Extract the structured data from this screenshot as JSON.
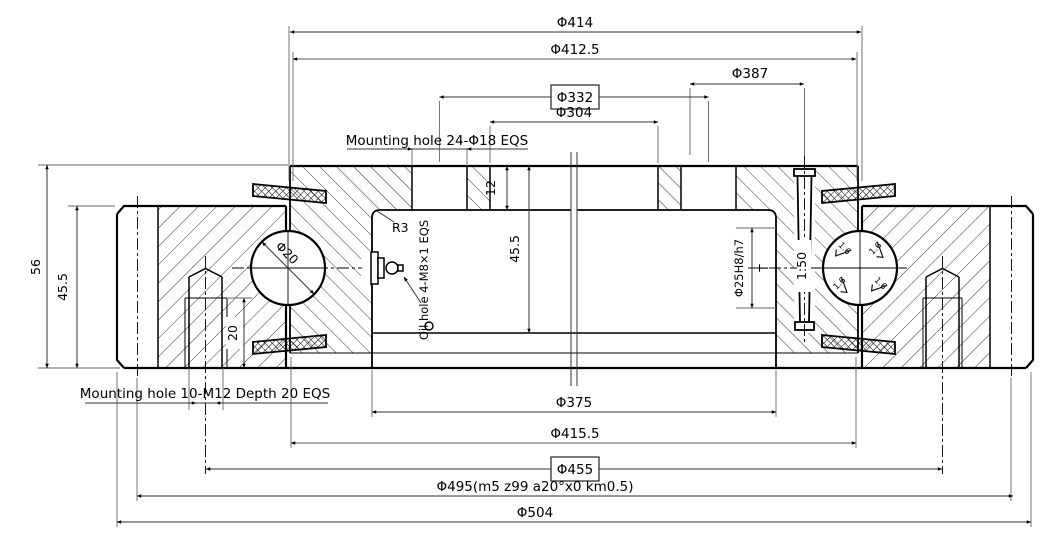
{
  "dimensions": {
    "top": {
      "d414": "Φ414",
      "d412_5": "Φ412.5",
      "d387": "Φ387",
      "d332": "Φ332",
      "d304": "Φ304"
    },
    "bottom": {
      "d375": "Φ375",
      "d415_5": "Φ415.5",
      "d455": "Φ455",
      "d495": "Φ495(m5 z99 a20°x0 km0.5)",
      "d504": "Φ504"
    },
    "left": {
      "total_height": "56",
      "ring_height": "45.5",
      "thread_depth": "20"
    },
    "middle": {
      "inner_height": "45.5",
      "flange_step": "12"
    },
    "right": {
      "pin_bore": "Φ25H8/h7",
      "pin_depth": "T",
      "pin_taper": "1:50"
    },
    "ball_diameter": "Φ20",
    "fillet": "R3"
  },
  "labels": {
    "mounting_hole_top": "Mounting hole 24-Φ18 EQS",
    "mounting_hole_bottom": "Mounting hole 10-M12 Depth 20 EQS",
    "oil_hole": "Oil hole 4-M8×1 EQS",
    "surface_finish": "1.6"
  },
  "colors": {
    "line": "#000000",
    "dim_line": "#555555",
    "background": "#ffffff"
  }
}
